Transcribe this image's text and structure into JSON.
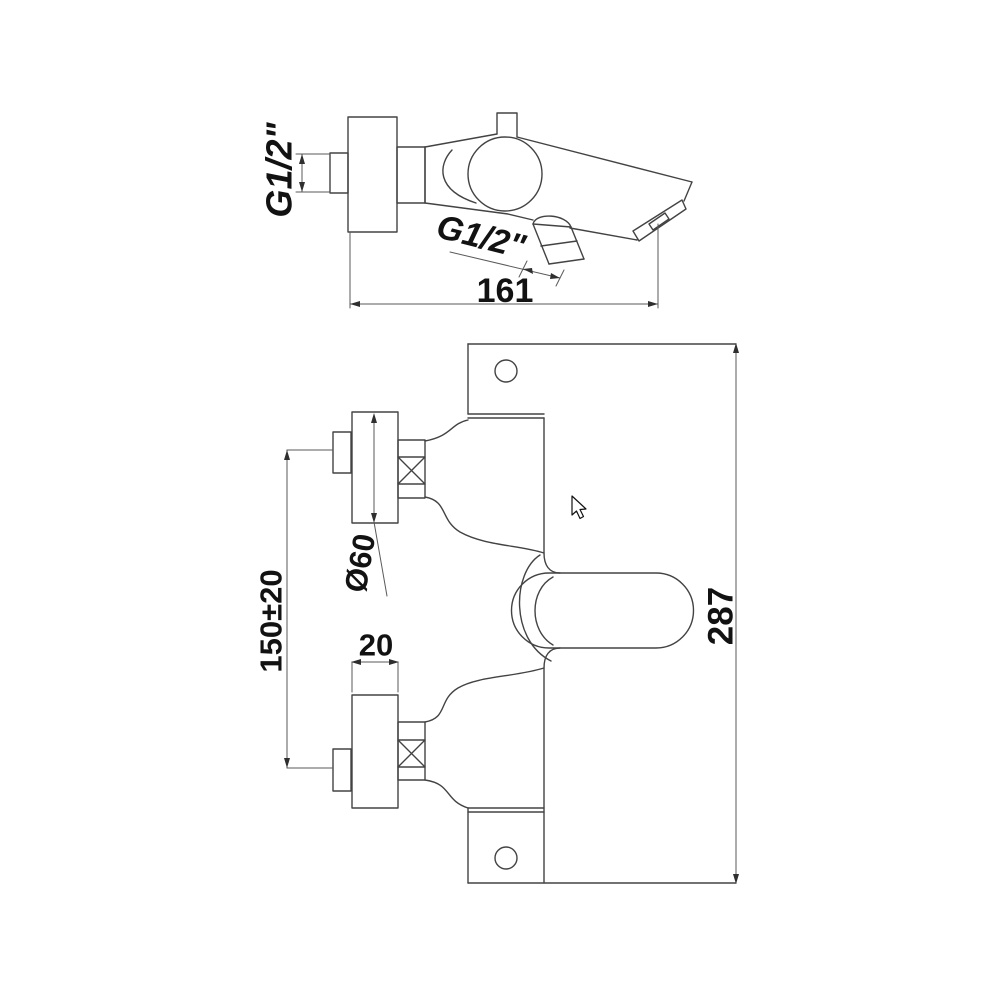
{
  "meta": {
    "type": "technical-drawing",
    "subject": "wall-mounted bath shower mixer tap, two-view dimensioned drawing",
    "background_color": "#ffffff",
    "line_color": "#434343",
    "text_color": "#121212"
  },
  "views": {
    "side_view": {
      "dim_inlet_thread": "G1/2\"",
      "dim_outlet_thread": "G1/2\"",
      "dim_overall_depth": "161"
    },
    "front_view": {
      "dim_escutcheon_diameter": "Ø60",
      "dim_inlet_centres": "150±20",
      "dim_escutcheon_depth": "20",
      "dim_overall_height": "287"
    }
  },
  "cursor": {
    "shape": "arrow-pointer"
  }
}
